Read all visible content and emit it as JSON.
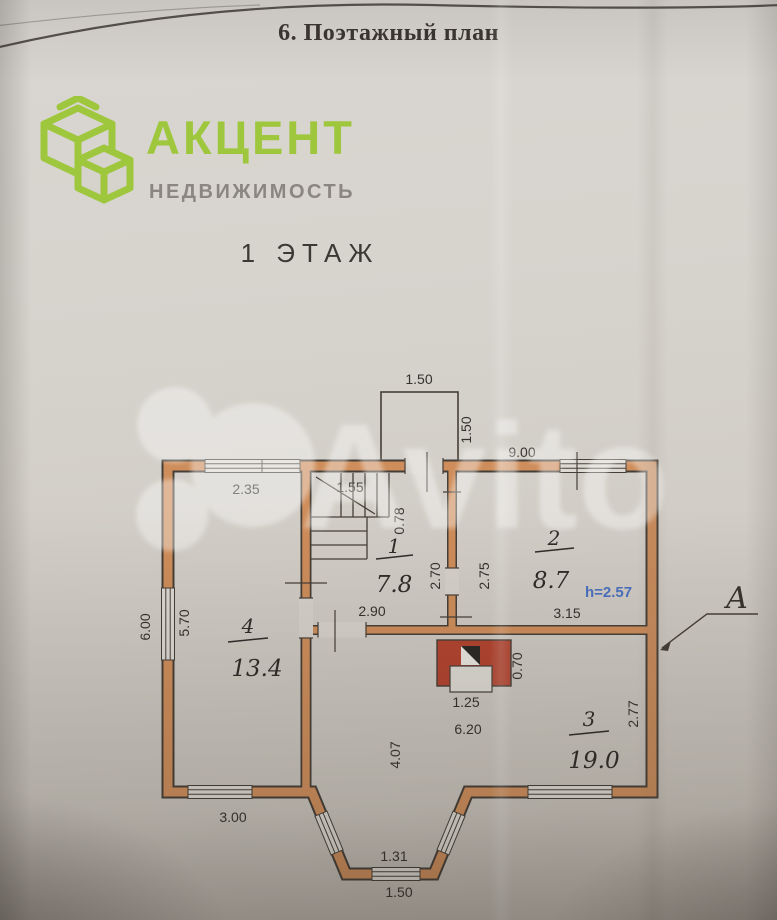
{
  "header": {
    "title": "6. Поэтажный план"
  },
  "logo": {
    "brand": "АКЦЕНТ",
    "subtitle": "НЕДВИЖИМОСТЬ",
    "brand_color": "#9ec73d",
    "subtitle_color": "#8b8780"
  },
  "floor_label": "1 ЭТАЖ",
  "watermark": {
    "text": "Avito"
  },
  "plan": {
    "axis_label": "А",
    "height_note": "h=2.57",
    "height_note_color": "#4a70bf",
    "wall_color": "#ce8d5a",
    "stove_color": "#b2432f",
    "rooms": [
      {
        "number": "1",
        "area": "7.8"
      },
      {
        "number": "2",
        "area": "8.7"
      },
      {
        "number": "3",
        "area": "19.0"
      },
      {
        "number": "4",
        "area": "13.4"
      }
    ],
    "dims": {
      "porch_top": "1.50",
      "porch_side": "1.50",
      "top_total": "9.00",
      "room4_top": "2.35",
      "stair_width": "1.55",
      "stair_depth": "0.78",
      "room1_right": "2.70",
      "room2_left": "2.75",
      "room2_bottom": "3.15",
      "room1_bottom": "2.90",
      "left_total": "6.00",
      "room4_left": "5.70",
      "stove_width": "1.25",
      "stove_side": "0.70",
      "hall_width": "6.20",
      "hall_left": "4.07",
      "room3_right": "2.77",
      "room4_bottom": "3.00",
      "bay_inner": "1.31",
      "bay_outer": "1.50"
    }
  }
}
